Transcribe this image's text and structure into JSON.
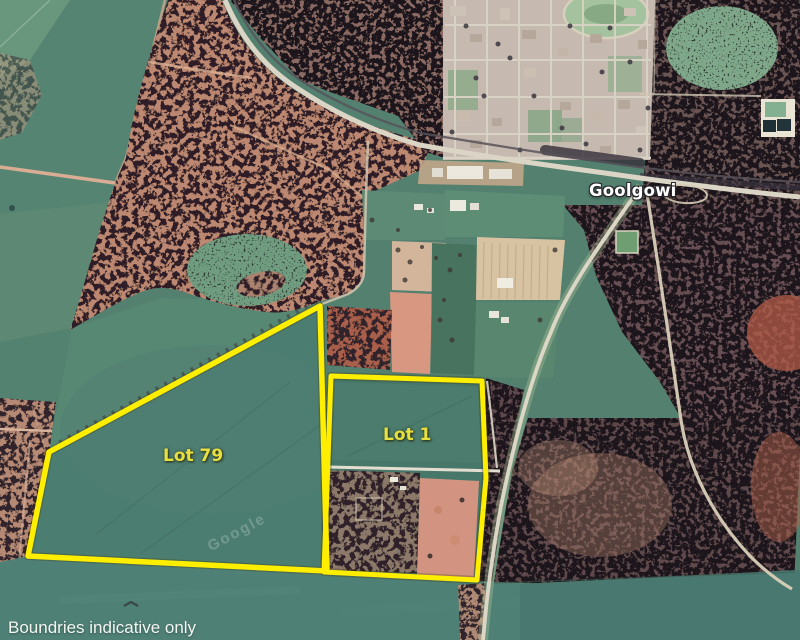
{
  "map": {
    "town_label": "Goolgowi",
    "lots": [
      {
        "label": "Lot 79"
      },
      {
        "label": "Lot 1"
      }
    ],
    "disclaimer": "Boundries indicative only",
    "watermark": "Google",
    "colors": {
      "boundary": "#FFEE00",
      "lot_label_text": "#E8E03F",
      "town_label_text": "#FFFFFF",
      "disclaimer_text": "#F4F6F2"
    }
  }
}
